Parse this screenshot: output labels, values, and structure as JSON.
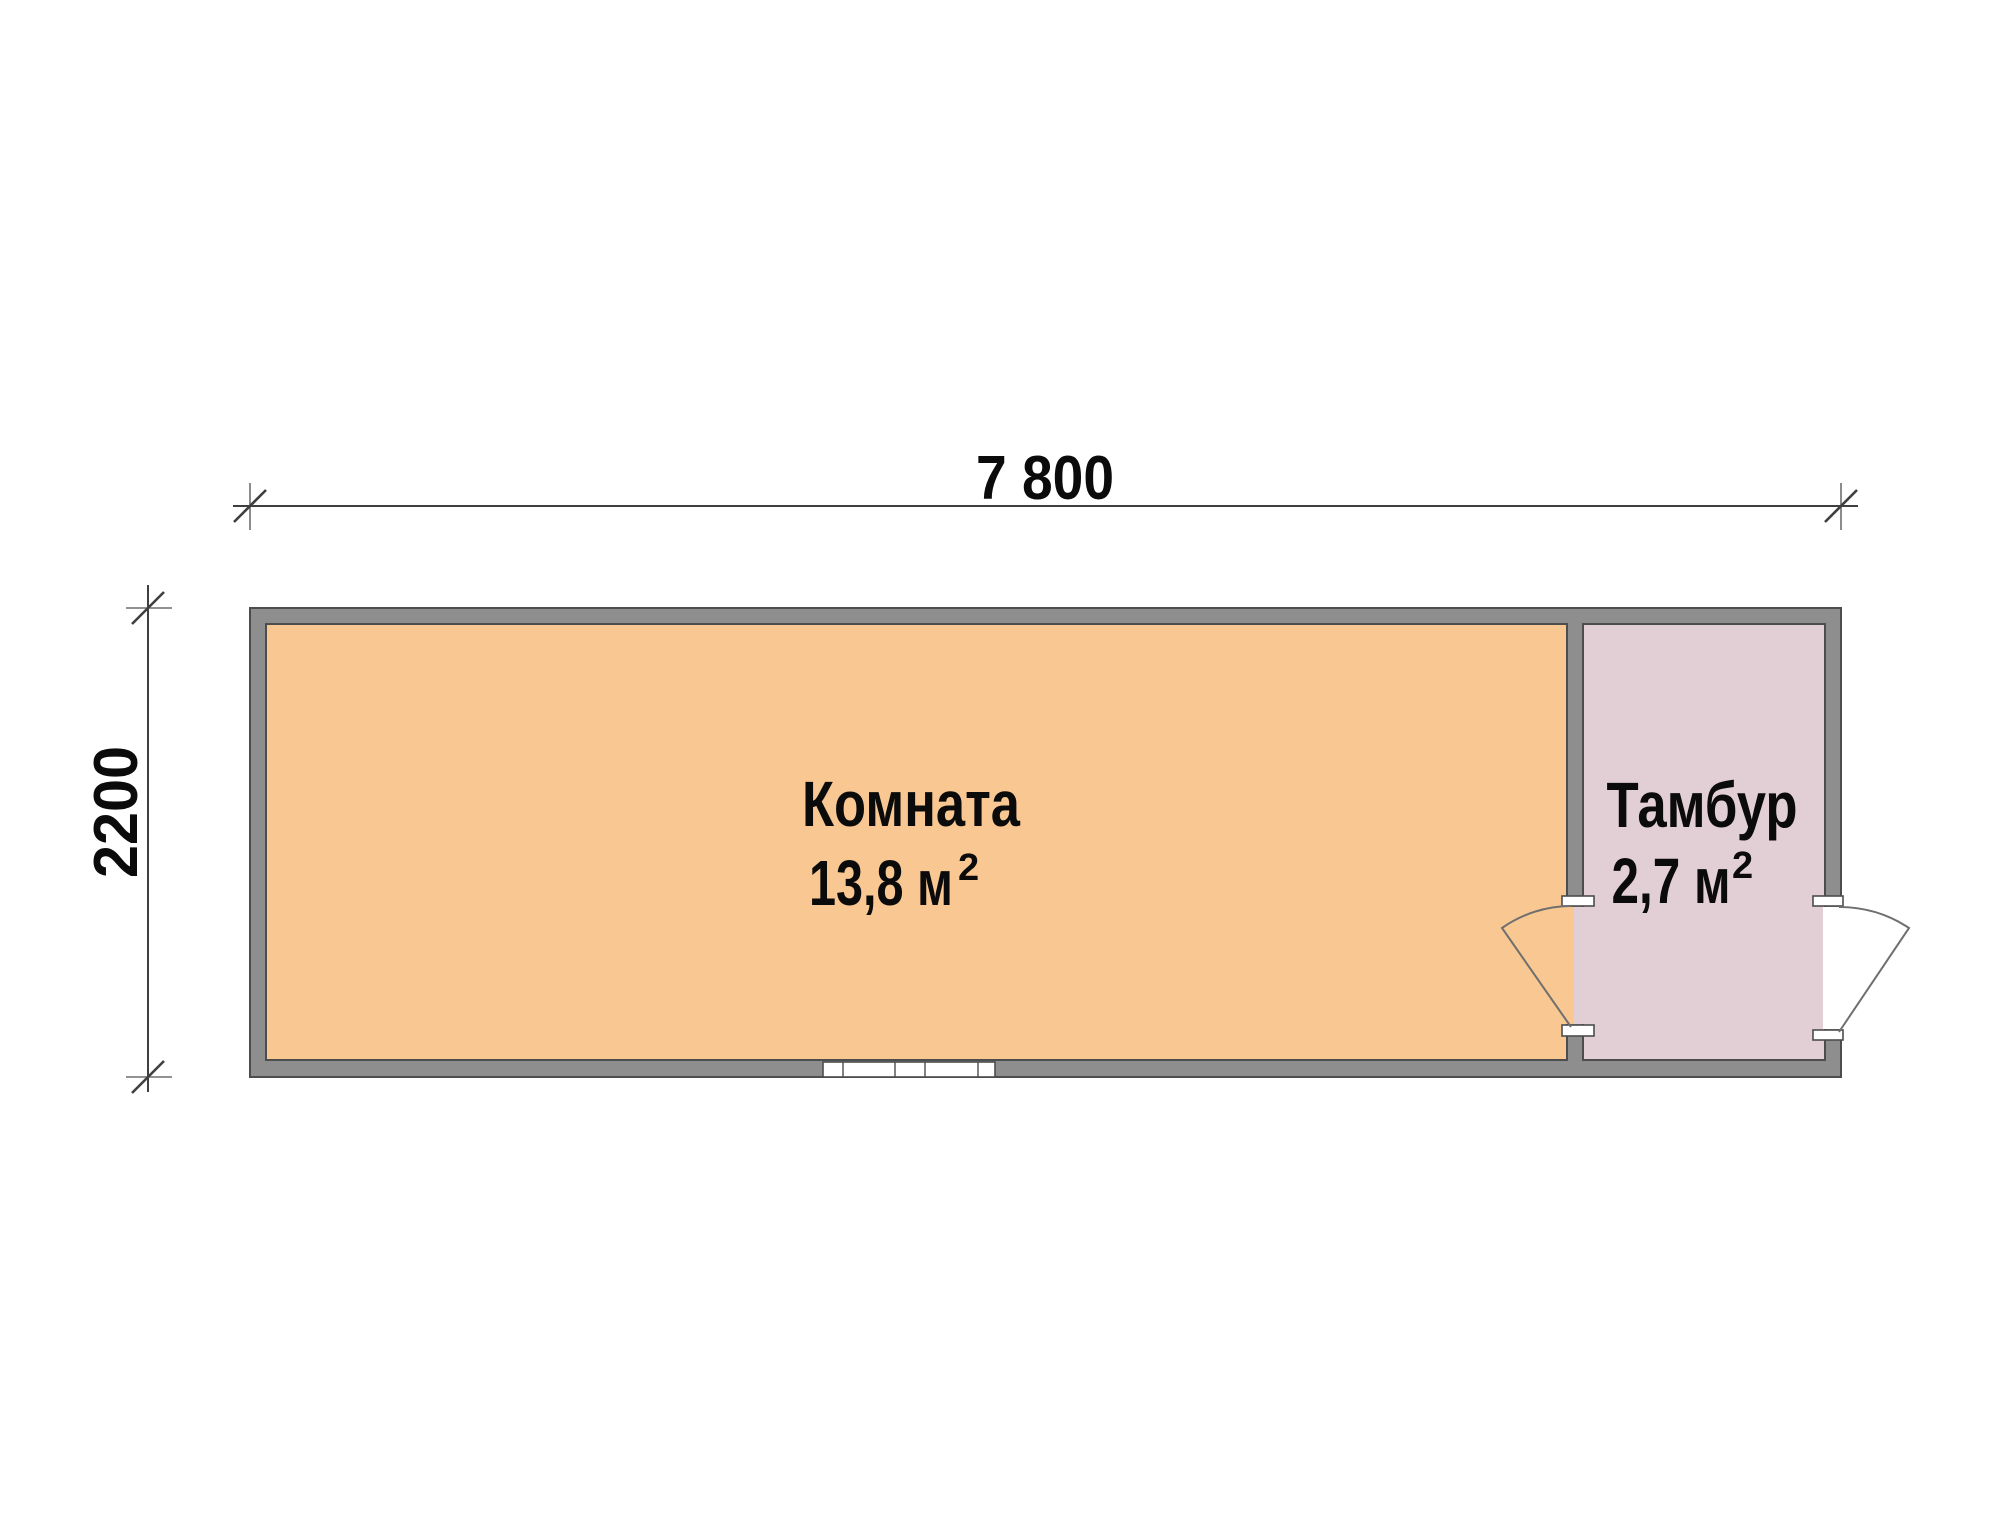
{
  "plan": {
    "dimensions": {
      "width_label": "7 800",
      "height_label": "2200"
    },
    "rooms": [
      {
        "name": "Комната",
        "area_text": "13,8 м",
        "area_superscript": "2"
      },
      {
        "name": "Тамбур",
        "area_text": "2,7 м",
        "area_superscript": "2"
      }
    ],
    "colors": {
      "room_main_fill": "#f9c791",
      "room_entry_fill": "#e2ced5",
      "wall_fill": "#8e8e8e",
      "outline": "#4d4d4d",
      "dimension_line": "#3f3f3f",
      "text": "#0b0b0b",
      "opening_fill": "#ffffff"
    }
  }
}
